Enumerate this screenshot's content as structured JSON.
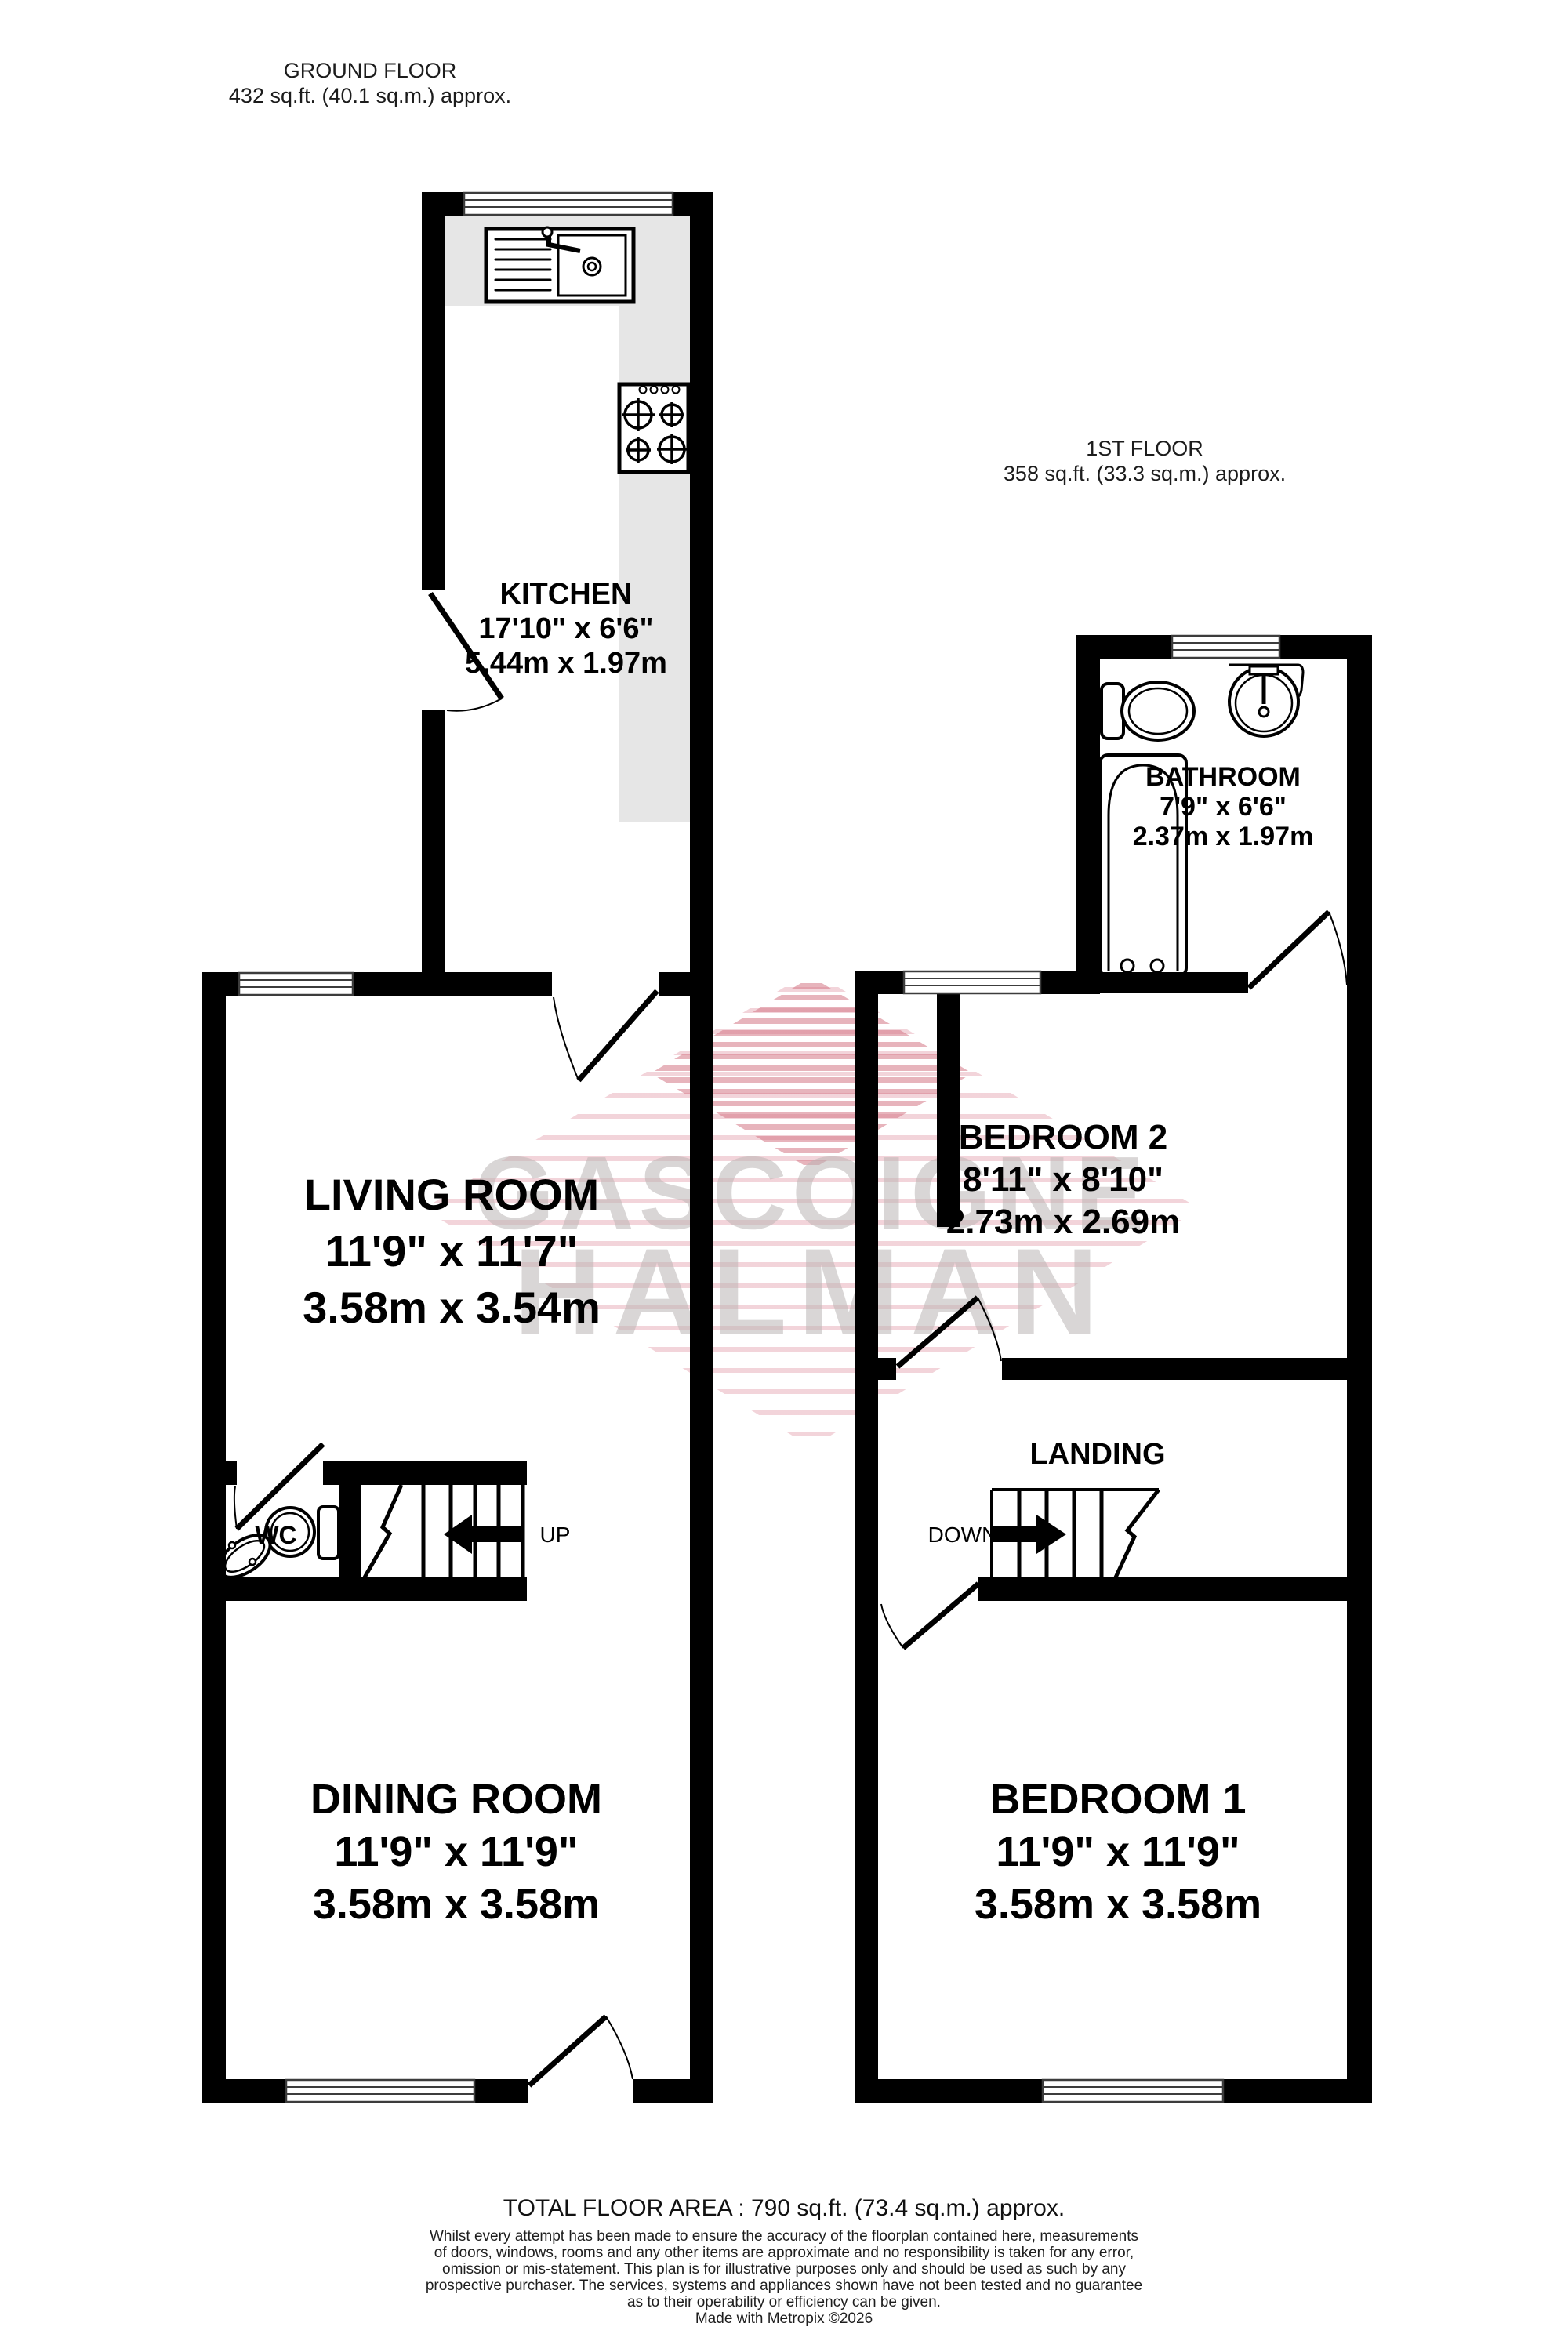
{
  "floors": {
    "ground": {
      "title": "GROUND FLOOR",
      "area": "432 sq.ft. (40.1 sq.m.) approx."
    },
    "first": {
      "title": "1ST FLOOR",
      "area": "358 sq.ft. (33.3 sq.m.) approx."
    }
  },
  "rooms": {
    "kitchen": {
      "name": "KITCHEN",
      "imperial": "17'10\"  x 6'6\"",
      "metric": "5.44m  x 1.97m"
    },
    "bathroom": {
      "name": "BATHROOM",
      "imperial": "7'9\"  x 6'6\"",
      "metric": "2.37m  x 1.97m"
    },
    "living_room": {
      "name": "LIVING ROOM",
      "imperial": "11'9\"  x 11'7\"",
      "metric": "3.58m  x 3.54m"
    },
    "bedroom2": {
      "name": "BEDROOM 2",
      "imperial": "8'11\"  x 8'10\"",
      "metric": "2.73m  x 2.69m"
    },
    "dining_room": {
      "name": "DINING ROOM",
      "imperial": "11'9\"  x 11'9\"",
      "metric": "3.58m  x 3.58m"
    },
    "bedroom1": {
      "name": "BEDROOM 1",
      "imperial": "11'9\"  x 11'9\"",
      "metric": "3.58m  x 3.58m"
    },
    "landing": {
      "name": "LANDING"
    },
    "wc": {
      "name": "WC"
    }
  },
  "stairs": {
    "up_label": "UP",
    "down_label": "DOWN"
  },
  "watermark": {
    "line1": "GASCOIGNE",
    "line2": "HALMAN"
  },
  "footer": {
    "total_area": "TOTAL FLOOR AREA : 790 sq.ft. (73.4 sq.m.) approx.",
    "disclaimer": [
      "Whilst every attempt has been made to ensure the accuracy of the floorplan contained here, measurements",
      "of doors, windows, rooms and any other items are approximate and no responsibility is taken for any error,",
      "omission or mis-statement. This plan is for illustrative purposes only and should be used as such by any",
      "prospective purchaser. The services, systems and appliances shown have not been tested and no guarantee",
      "as to their operability or efficiency can be given."
    ],
    "credit": "Made with Metropix ©2026"
  },
  "colors": {
    "wall": "#000000",
    "counter": "#e6e6e6",
    "watermark_pink": "#e094a2",
    "watermark_red": "#d37685",
    "watermark_text": "#bab4b4"
  }
}
